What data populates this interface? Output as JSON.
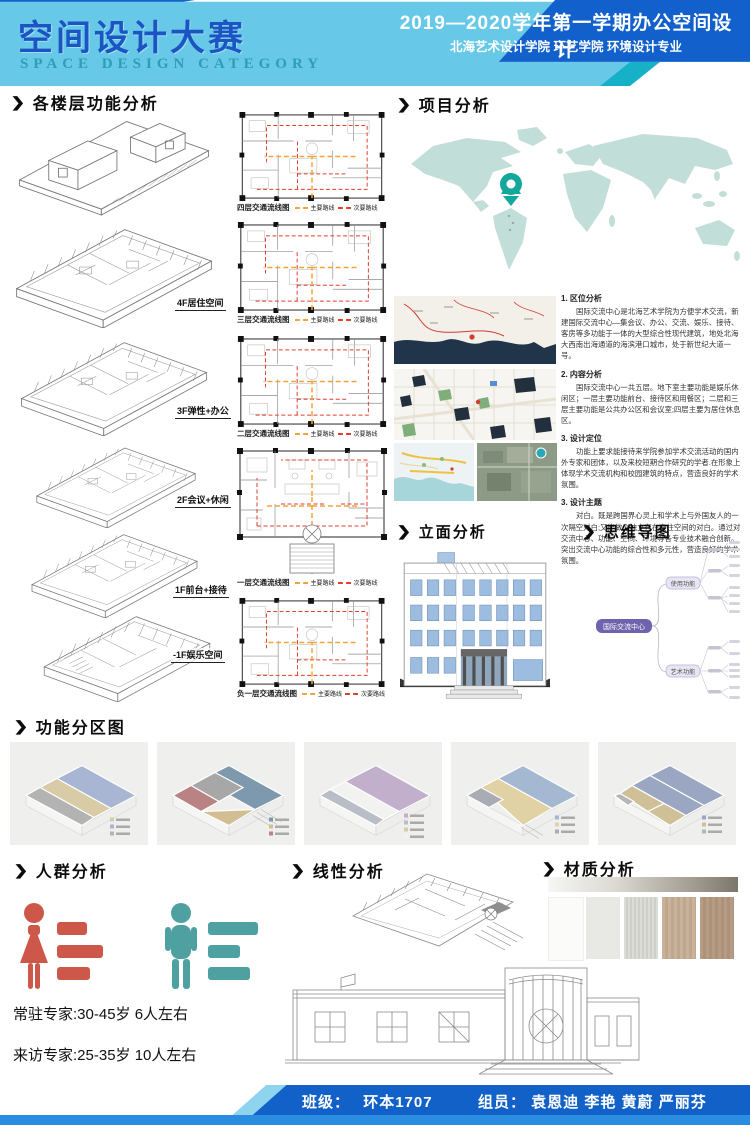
{
  "icons": {
    "chevron": "❯"
  },
  "colors": {
    "header_light_blue": "#67c8e7",
    "header_dark_blue": "#1160cb",
    "accent_teal": "#16b1c6",
    "route_main": "#f2a33c",
    "route_secondary": "#e23d2e",
    "female_red": "#cd584a",
    "male_teal": "#4fa1a1",
    "map_land": "#c2ded8",
    "pin_teal": "#14a79b",
    "mindmap_center_purple": "#6e63ac"
  },
  "header": {
    "title": "空间设计大赛",
    "subtitle": "SPACE DESIGN CATEGORY",
    "course": "2019—2020学年第一学期办公空间设计",
    "school": "北海艺术设计学院  环艺学院  环境设计专业"
  },
  "floors": {
    "title": "各楼层功能分析",
    "items": [
      "4F居住空间",
      "3F弹性+办公",
      "2F会议+休闲",
      "1F前台+接待",
      "-1F娱乐空间"
    ]
  },
  "circulation": {
    "labels": [
      "四层交通流线图",
      "三层交通流线图",
      "二层交通流线图",
      "一层交通流线图",
      "负一层交通流线图"
    ],
    "legend": {
      "main": "主要路线",
      "secondary": "次要路线"
    }
  },
  "project": {
    "title": "项目分析",
    "items": [
      {
        "heading": "1. 区位分析",
        "body": "国际交流中心是北海艺术学院为方便学术交流，新建国际交流中心—集会议、办公、交流、娱乐、接待、客房等多功能于一体的大型综合性现代建筑，地处北海大西南出海通道的海滨港口城市，处于新世纪大道一号。"
      },
      {
        "heading": "2. 内容分析",
        "body": "国际交流中心一共五层。地下室主要功能是娱乐休闲区；一层主要功能前台、接待区和用餐区；二层和三层主要功能是公共办公区和会议室;四层主要为居住休息区。"
      },
      {
        "heading": "3. 设计定位",
        "body": "功能上要求能接待来学院参加学术交流活动的国内外专家和团体，以及来校短期合作研究的学者.在形象上体现学术交流机构和校园建筑的特点，营造良好的学术氛围。"
      },
      {
        "heading": "3. 设计主题",
        "body": "对白。既是跨国界心灵上和学术上与外国友人的一次隔空对白;又能做个独立存在交往空间的对白。通过对交流中心、功能、空间、环境等各专业技术融合创新。突出交流中心功能的综合性和多元性，营造良好的学术氛围。"
      }
    ]
  },
  "elevation": {
    "title": "立面分析"
  },
  "mindmap": {
    "title": "思维导图",
    "center": "国际交流中心",
    "branch_top": "使用功能",
    "branch_bottom": "艺术功能"
  },
  "zoning": {
    "title": "功能分区图",
    "palette": [
      "#a9b6d3",
      "#d9cba6",
      "#7e99ad",
      "#c2afcc",
      "#9aa6c2",
      "#b98383"
    ]
  },
  "people": {
    "title": "人群分析",
    "lines": [
      "常驻专家:30-45岁 6人左右",
      "来访专家:25-35岁 10人左右"
    ]
  },
  "linear": {
    "title": "线性分析"
  },
  "material": {
    "title": "材质分析"
  },
  "footer": {
    "class_label": "班级：",
    "class_value": "环本1707",
    "team_label": "组员：",
    "team_value": "袁恩迪 李艳 黄蔚 严丽芬"
  }
}
